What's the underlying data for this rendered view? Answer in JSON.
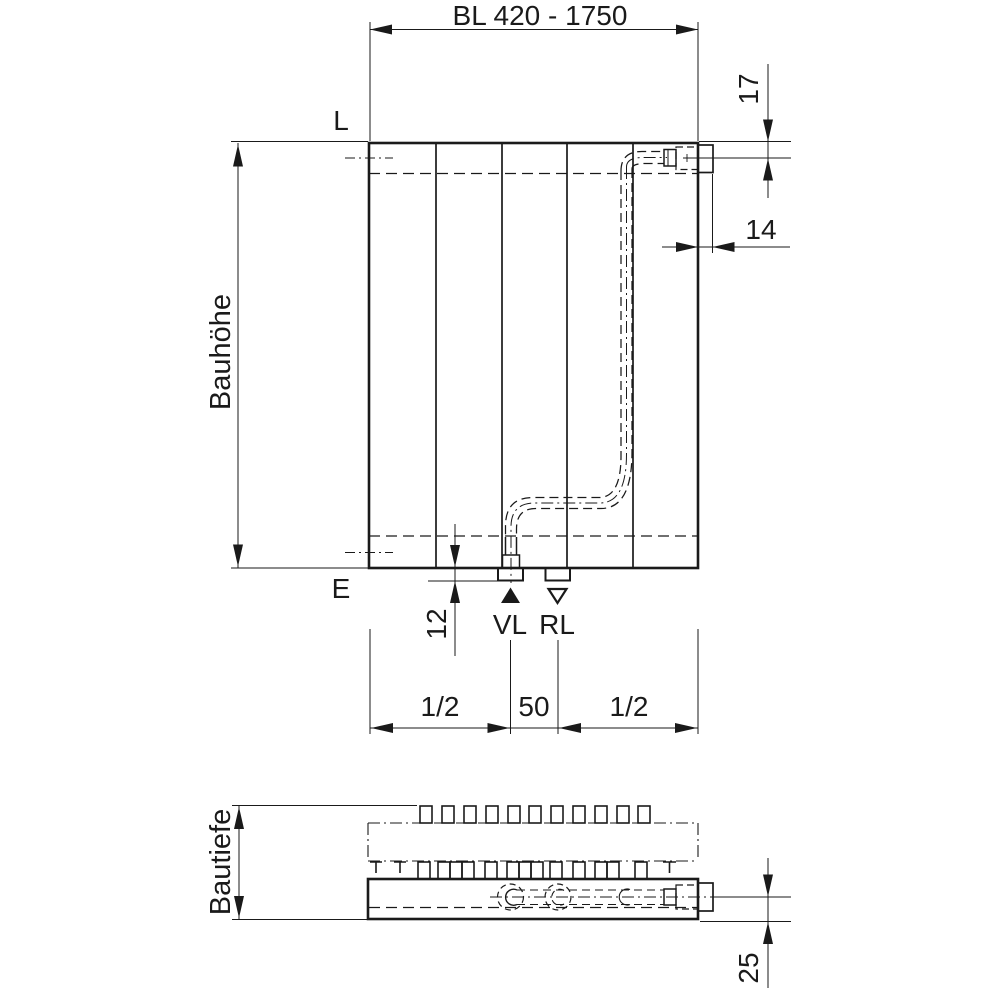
{
  "page": {
    "background": "#ffffff",
    "line_color": "#1a1a1a",
    "description": "Technical dimension drawing of a panel radiator, front view and bottom section view"
  },
  "front_view": {
    "dim_width_label": "BL 420 - 1750",
    "vent_label": "L",
    "drain_label": "E",
    "height_label": "Bauhöhe",
    "top_connection_offset": "17",
    "side_connection_offset": "14",
    "stub_length": "12",
    "supply_label": "VL",
    "return_label": "RL",
    "left_half_label": "1/2",
    "center_spacing_label": "50",
    "right_half_label": "1/2"
  },
  "bottom_view": {
    "depth_label": "Bautiefe",
    "connection_height_label": "25"
  }
}
